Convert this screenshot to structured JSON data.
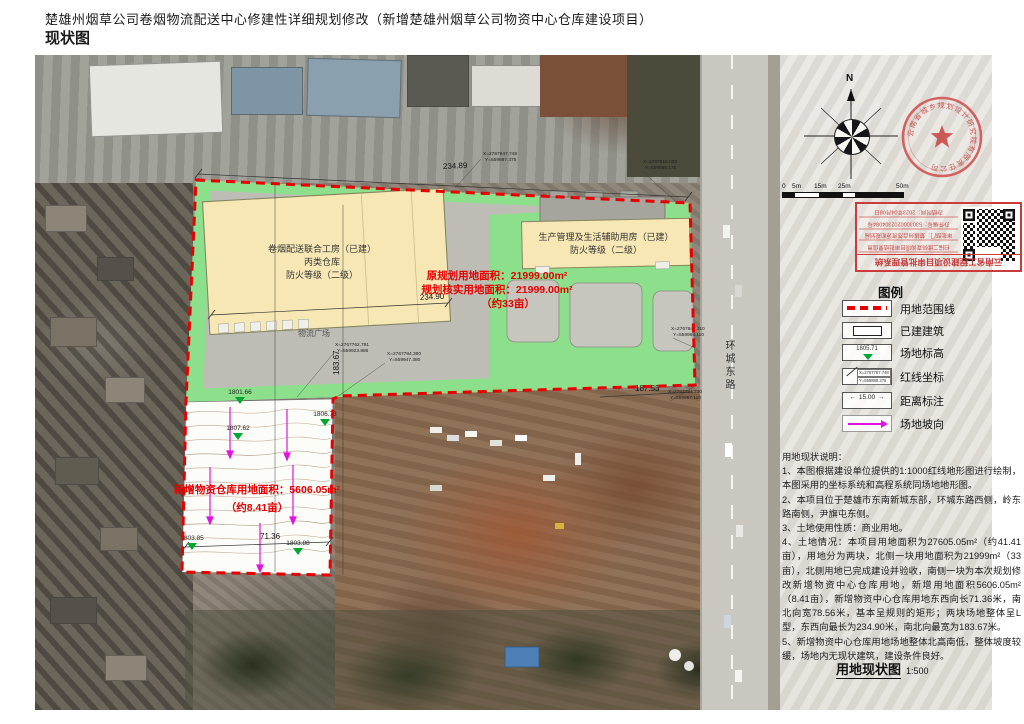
{
  "header": {
    "title": "楚雄州烟草公司卷烟物流配送中心修建性详细规划修改（新增楚雄州烟草公司物资中心仓库建设项目）",
    "subtitle": "现状图"
  },
  "map": {
    "plaza_label": "物流广场",
    "road_label": "环城东路",
    "building1": {
      "l1": "卷烟配送联合工房（已建）",
      "l2": "丙类仓库",
      "l3": "防火等级（二级）"
    },
    "building2": {
      "l1": "生产管理及生活辅助用房（已建）",
      "l2": "防火等级（二级）"
    },
    "area_note": {
      "l1": "原规划用地面积：21999.00m²",
      "l2": "规划核实用地面积：21999.00m²",
      "l3": "（约33亩）"
    },
    "new_area_note": {
      "l1": "新增物资仓库用地面积：5606.05m²",
      "l2": "（约8.41亩）"
    },
    "dims": {
      "top": "234.89",
      "building": "234.90",
      "ns": "183.67",
      "east": "187.53",
      "south": "71.36"
    },
    "elevations": [
      {
        "v": "1801.66"
      },
      {
        "v": "1807.62"
      },
      {
        "v": "1806.73"
      },
      {
        "v": "1803.85"
      },
      {
        "v": "1803.88"
      }
    ],
    "coords": [
      {
        "x": "X=2767947.748",
        "y": "Y=559887.375"
      },
      {
        "x": "X=2767919.085",
        "y": "Y=559966.170"
      },
      {
        "x": "X=2767762.791",
        "y": "Y=559923.886"
      },
      {
        "x": "X=2767784.380",
        "y": "Y=559947.380"
      },
      {
        "x": "X=2767847.110",
        "y": "Y=559968.110"
      },
      {
        "x": "X=2767784.230",
        "y": "Y=559967.110"
      }
    ]
  },
  "panel": {
    "north_label": "N",
    "scale_ticks": [
      "0",
      "5m",
      "15m",
      "25m",
      "50m"
    ],
    "seal_text": "云南省城乡规划设计研究院有限责任公司",
    "approval_box": {
      "lines": [
        "办结时间：2023年04月08日",
        "办件编号：5303000202304084号",
        "审批部门：楚雄州自然资源和规划局",
        "扫描二维码查询项目审批结果信息"
      ],
      "footer": "云南省工程建设项目审批管理系统"
    },
    "legend": {
      "title": "图例",
      "items": [
        {
          "label": "用地范围线"
        },
        {
          "label": "已建建筑"
        },
        {
          "label": "场地标高",
          "sample": "1805.71"
        },
        {
          "label": "红线坐标",
          "sample_x": "X=2767767.748",
          "sample_y": "Y=559888.375"
        },
        {
          "label": "距离标注",
          "sample": "15.00"
        },
        {
          "label": "场地坡向"
        }
      ]
    },
    "notes": {
      "title": "用地现状说明：",
      "items": [
        "1、本图根据建设单位提供的1:1000红线地形图进行绘制，本图采用的坐标系统和高程系统同场地地形图。",
        "2、本项目位于楚雄市东南新城东部，环城东路西侧，岭东路南侧，尹旗屯东侧。",
        "3、土地使用性质：商业用地。",
        "4、土地情况：本项目用地面积为27605.05m²（约41.41亩），用地分为两块，北侧一块用地面积为21999m²（33亩），北侧用地已完成建设并验收，南侧一块为本次规划修改新增物资中心仓库用地，新增用地面积5606.05m²（8.41亩），新增物资中心仓库用地东西向长71.36米，南北向宽78.56米，基本呈规则的矩形；两块场地整体呈L型，东西向最长为234.90米，南北向最宽为183.67米。",
        "5、新增物资中心仓库用地场地整体北高南低，整体坡度较缓，场地内无现状建筑，建设条件良好。"
      ]
    },
    "footer": {
      "title": "用地现状图",
      "scale": "1:500"
    }
  }
}
